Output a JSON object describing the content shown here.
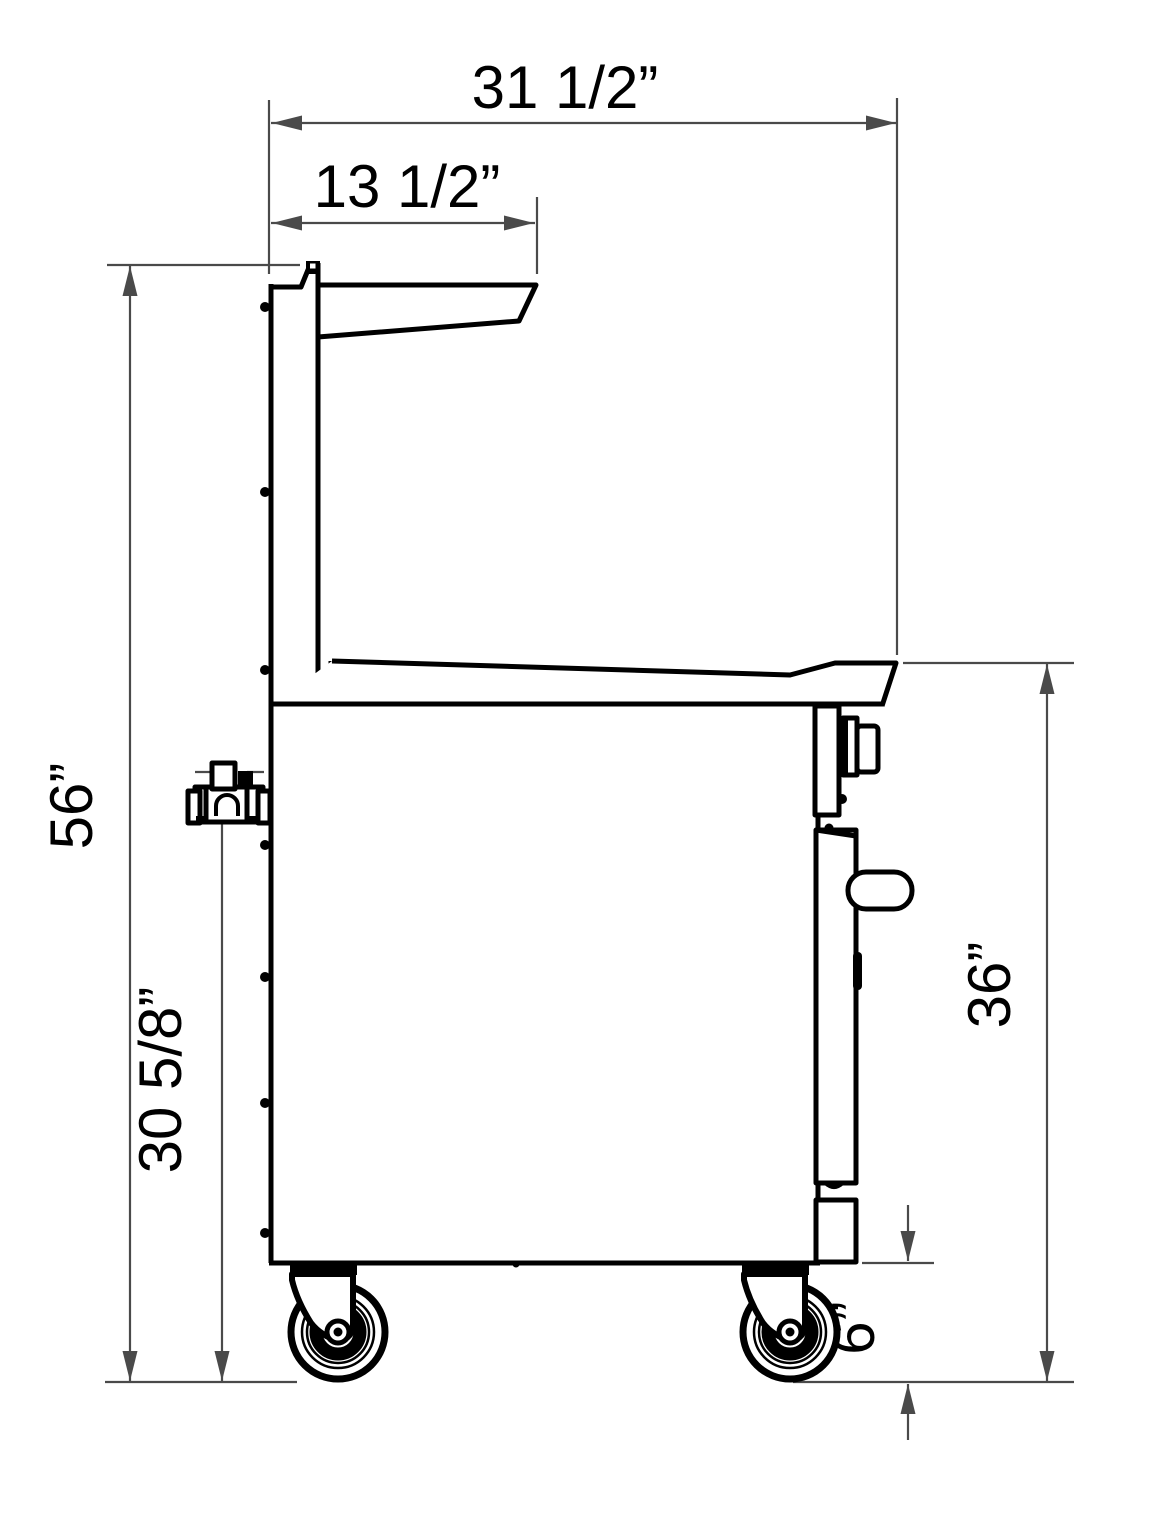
{
  "colors": {
    "object_line": "#000000",
    "dimension_line": "#4a4a4a",
    "background": "#ffffff"
  },
  "dims": {
    "overall_depth": "31 1/2”",
    "shelf_depth": "13 1/2”",
    "overall_height": "56”",
    "gas_height": "30 5/8”",
    "surface_height": "36”",
    "caster_height": "6”"
  }
}
